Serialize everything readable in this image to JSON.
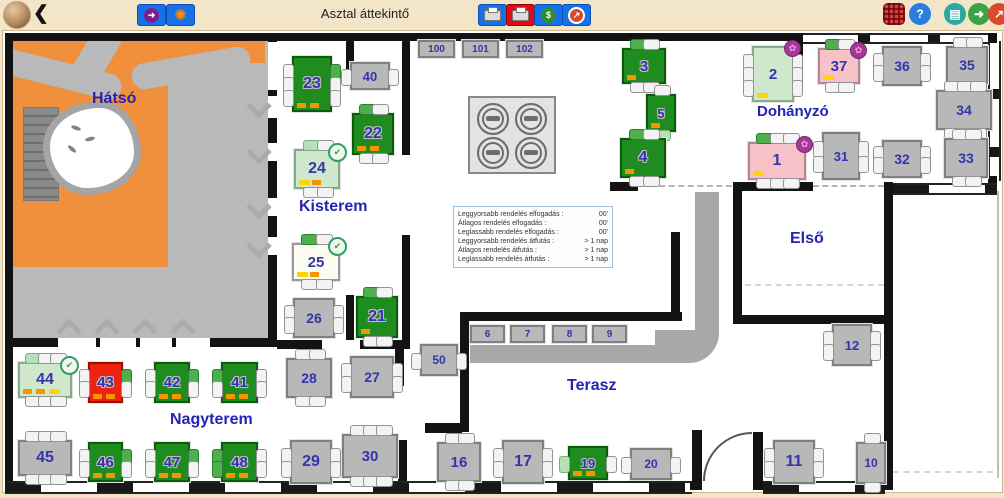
{
  "header": {
    "title": "Asztal áttekintő",
    "back_glyph": "❮",
    "help_glyph": "?"
  },
  "icons": {
    "check_glyph": "✔",
    "flower_glyph": "✿",
    "arrow_glyph": "➜",
    "burst_glyph": "✺",
    "dollar_glyph": "$",
    "trend_glyph": "↗",
    "device_glyph": "▤",
    "exit_glyph": "➜"
  },
  "colors": {
    "header_bg": "#f3e6c8",
    "accent_blue": "#1670e8",
    "accent_red": "#e30b13",
    "table_green": "#1e8c1e",
    "table_gray": "#b8b8b8",
    "table_pale": "#cfe8cb",
    "table_pink": "#f6c2c8",
    "table_red": "#ee2211",
    "mark_orange": "#f79400",
    "mark_yellow": "#ffd400",
    "number": "#3434ac"
  },
  "rooms": [
    {
      "id": "hatso",
      "label": "Hátsó"
    },
    {
      "id": "kisterem",
      "label": "Kisterem"
    },
    {
      "id": "dohanyzo",
      "label": "Dohányzó"
    },
    {
      "id": "elso",
      "label": "Első"
    },
    {
      "id": "terasz",
      "label": "Terasz"
    },
    {
      "id": "nagyterem",
      "label": "Nagyterem"
    }
  ],
  "stats_box": {
    "lines": [
      {
        "label": "Leggyorsabb rendelés elfogadás :",
        "value": "00'"
      },
      {
        "label": "Átlagos rendelés elfogadás :",
        "value": "00'"
      },
      {
        "label": "Leglassabb rendelés elfogadás :",
        "value": "00'"
      },
      {
        "label": "Leggyorsabb rendelés átfutás :",
        "value": "> 1 nap"
      },
      {
        "label": "Átlagos rendelés átfutás :",
        "value": "> 1 nap"
      },
      {
        "label": "Leglassabb rendelés átfutás :",
        "value": "> 1 nap"
      }
    ]
  },
  "tables": [
    {
      "label": "23",
      "x": 292,
      "y": 56,
      "w": 36,
      "h": 52,
      "color": "green",
      "fs": 16,
      "seats": {
        "l": [
          "w",
          "w",
          "w"
        ],
        "r": [
          "g",
          "w",
          "w"
        ]
      },
      "marks": [
        "orange",
        "orange"
      ]
    },
    {
      "label": "40",
      "x": 350,
      "y": 62,
      "w": 36,
      "h": 24,
      "color": "gray",
      "fs": 13,
      "seats": {
        "l": [
          "w"
        ],
        "r": [
          "w"
        ]
      }
    },
    {
      "label": "22",
      "x": 352,
      "y": 113,
      "w": 38,
      "h": 38,
      "color": "green",
      "fs": 16,
      "seats": {
        "t": [
          "g",
          "w"
        ],
        "b": [
          "w",
          "w"
        ]
      },
      "marks": [
        "orange",
        "orange"
      ]
    },
    {
      "label": "24",
      "x": 294,
      "y": 149,
      "w": 42,
      "h": 36,
      "color": "pale",
      "fs": 16,
      "badge": "check",
      "seats": {
        "t": [
          "p",
          "w"
        ],
        "b": [
          "w",
          "w"
        ]
      },
      "marks": [
        "yellow",
        "orange"
      ]
    },
    {
      "label": "25",
      "x": 292,
      "y": 243,
      "w": 44,
      "h": 34,
      "color": "white",
      "fs": 15,
      "badge": "check",
      "seats": {
        "t": [
          "g",
          "w"
        ],
        "b": [
          "w",
          "w"
        ]
      },
      "marks": [
        "yellow",
        "orange"
      ]
    },
    {
      "label": "26",
      "x": 293,
      "y": 298,
      "w": 38,
      "h": 36,
      "color": "gray",
      "fs": 14,
      "seats": {
        "l": [
          "w",
          "w"
        ],
        "r": [
          "w",
          "w"
        ]
      }
    },
    {
      "label": "21",
      "x": 356,
      "y": 296,
      "w": 38,
      "h": 38,
      "color": "green",
      "fs": 16,
      "seats": {
        "t": [
          "g",
          "w"
        ],
        "b": [
          "w",
          "w"
        ]
      },
      "marks": [
        "orange"
      ]
    },
    {
      "label": "100",
      "x": 418,
      "y": 40,
      "w": 33,
      "h": 14,
      "color": "gray",
      "fs": 10,
      "seats": {}
    },
    {
      "label": "101",
      "x": 462,
      "y": 40,
      "w": 33,
      "h": 14,
      "color": "gray",
      "fs": 10,
      "seats": {}
    },
    {
      "label": "102",
      "x": 506,
      "y": 40,
      "w": 33,
      "h": 14,
      "color": "gray",
      "fs": 10,
      "seats": {}
    },
    {
      "label": "3",
      "x": 622,
      "y": 48,
      "w": 40,
      "h": 32,
      "color": "green",
      "fs": 15,
      "seats": {
        "t": [
          "g",
          "w"
        ],
        "b": [
          "w",
          "w"
        ]
      },
      "marks": [
        "orange"
      ]
    },
    {
      "label": "5",
      "x": 646,
      "y": 94,
      "w": 26,
      "h": 34,
      "color": "green",
      "fs": 13,
      "seats": {
        "t": [
          "w"
        ],
        "b": [
          "p"
        ]
      },
      "marks": [
        "orange"
      ]
    },
    {
      "label": "4",
      "x": 620,
      "y": 138,
      "w": 42,
      "h": 36,
      "color": "green",
      "fs": 16,
      "seats": {
        "t": [
          "g",
          "w"
        ],
        "b": [
          "w",
          "w"
        ]
      },
      "marks": [
        "orange"
      ]
    },
    {
      "label": "2",
      "x": 752,
      "y": 46,
      "w": 38,
      "h": 52,
      "color": "pale",
      "fs": 15,
      "badge": "flower",
      "seats": {
        "l": [
          "w",
          "w",
          "w"
        ],
        "r": [
          "w",
          "w",
          "w"
        ]
      },
      "marks": [
        "yellow"
      ]
    },
    {
      "label": "37",
      "x": 818,
      "y": 48,
      "w": 38,
      "h": 32,
      "color": "pink",
      "fs": 15,
      "badge": "flower",
      "seats": {
        "t": [
          "g",
          "w"
        ],
        "b": [
          "w",
          "w"
        ]
      },
      "marks": [
        "yellow"
      ]
    },
    {
      "label": "36",
      "x": 882,
      "y": 46,
      "w": 36,
      "h": 36,
      "color": "gray",
      "fs": 14,
      "seats": {
        "l": [
          "w",
          "w"
        ],
        "r": [
          "w",
          "w"
        ]
      }
    },
    {
      "label": "35",
      "x": 946,
      "y": 46,
      "w": 38,
      "h": 34,
      "color": "gray",
      "fs": 14,
      "seats": {
        "t": [
          "w",
          "w"
        ],
        "b": [
          "w",
          "w"
        ]
      }
    },
    {
      "label": "34",
      "x": 936,
      "y": 90,
      "w": 52,
      "h": 36,
      "color": "gray",
      "fs": 14,
      "seats": {
        "t": [
          "w",
          "w",
          "w"
        ],
        "b": [
          "w",
          "w",
          "w"
        ]
      }
    },
    {
      "label": "1",
      "x": 748,
      "y": 142,
      "w": 54,
      "h": 34,
      "color": "pink",
      "fs": 16,
      "badge": "flower",
      "seats": {
        "t": [
          "g",
          "w",
          "w"
        ],
        "b": [
          "w",
          "w",
          "w"
        ]
      },
      "marks": [
        "yellow"
      ]
    },
    {
      "label": "31",
      "x": 822,
      "y": 132,
      "w": 34,
      "h": 44,
      "color": "gray",
      "fs": 13,
      "seats": {
        "l": [
          "w",
          "w"
        ],
        "r": [
          "w",
          "w"
        ]
      }
    },
    {
      "label": "32",
      "x": 882,
      "y": 140,
      "w": 36,
      "h": 34,
      "color": "gray",
      "fs": 14,
      "seats": {
        "l": [
          "w",
          "w"
        ],
        "r": [
          "w",
          "w"
        ]
      }
    },
    {
      "label": "33",
      "x": 944,
      "y": 138,
      "w": 40,
      "h": 36,
      "color": "gray",
      "fs": 14,
      "seats": {
        "t": [
          "w",
          "w"
        ],
        "b": [
          "w",
          "w"
        ]
      }
    },
    {
      "label": "12",
      "x": 832,
      "y": 324,
      "w": 36,
      "h": 38,
      "color": "gray",
      "fs": 13,
      "seats": {
        "l": [
          "w",
          "w"
        ],
        "r": [
          "w",
          "w"
        ]
      }
    },
    {
      "label": "6",
      "x": 470,
      "y": 325,
      "w": 31,
      "h": 14,
      "color": "gray",
      "fs": 10,
      "seats": {}
    },
    {
      "label": "7",
      "x": 510,
      "y": 325,
      "w": 31,
      "h": 14,
      "color": "gray",
      "fs": 10,
      "seats": {}
    },
    {
      "label": "8",
      "x": 552,
      "y": 325,
      "w": 31,
      "h": 14,
      "color": "gray",
      "fs": 10,
      "seats": {}
    },
    {
      "label": "9",
      "x": 592,
      "y": 325,
      "w": 31,
      "h": 14,
      "color": "gray",
      "fs": 10,
      "seats": {}
    },
    {
      "label": "50",
      "x": 420,
      "y": 344,
      "w": 34,
      "h": 28,
      "color": "gray",
      "fs": 12,
      "seats": {
        "l": [
          "w"
        ],
        "r": [
          "w"
        ]
      }
    },
    {
      "label": "44",
      "x": 18,
      "y": 362,
      "w": 50,
      "h": 32,
      "color": "pale",
      "fs": 16,
      "badge": "check",
      "seats": {
        "t": [
          "p",
          "w",
          "w"
        ],
        "b": [
          "w",
          "w",
          "w"
        ]
      },
      "marks": [
        "orange",
        "orange",
        "yellow"
      ]
    },
    {
      "label": "43",
      "x": 88,
      "y": 362,
      "w": 31,
      "h": 37,
      "color": "red",
      "fs": 15,
      "seats": {
        "l": [
          "w",
          "w"
        ],
        "r": [
          "g",
          "w"
        ]
      },
      "marks": [
        "orange",
        "orange"
      ]
    },
    {
      "label": "42",
      "x": 154,
      "y": 362,
      "w": 32,
      "h": 37,
      "color": "green",
      "fs": 15,
      "seats": {
        "l": [
          "w",
          "w"
        ],
        "r": [
          "g",
          "w"
        ]
      },
      "marks": [
        "orange",
        "orange"
      ]
    },
    {
      "label": "41",
      "x": 221,
      "y": 362,
      "w": 33,
      "h": 37,
      "color": "green",
      "fs": 15,
      "seats": {
        "l": [
          "g",
          "w"
        ],
        "r": [
          "w",
          "w"
        ]
      },
      "marks": [
        "orange",
        "orange"
      ]
    },
    {
      "label": "45",
      "x": 18,
      "y": 440,
      "w": 50,
      "h": 32,
      "color": "gray",
      "fs": 16,
      "seats": {
        "t": [
          "w",
          "w",
          "w"
        ],
        "b": [
          "w",
          "w",
          "w"
        ]
      }
    },
    {
      "label": "46",
      "x": 88,
      "y": 442,
      "w": 31,
      "h": 36,
      "color": "green",
      "fs": 15,
      "seats": {
        "l": [
          "w",
          "w"
        ],
        "r": [
          "g",
          "w"
        ]
      },
      "marks": [
        "orange",
        "orange"
      ]
    },
    {
      "label": "47",
      "x": 154,
      "y": 442,
      "w": 32,
      "h": 36,
      "color": "green",
      "fs": 15,
      "seats": {
        "l": [
          "w",
          "w"
        ],
        "r": [
          "g",
          "w"
        ]
      },
      "marks": [
        "orange",
        "orange"
      ]
    },
    {
      "label": "48",
      "x": 221,
      "y": 442,
      "w": 33,
      "h": 36,
      "color": "green",
      "fs": 15,
      "seats": {
        "l": [
          "g",
          "g"
        ],
        "r": [
          "w",
          "w"
        ]
      },
      "marks": [
        "orange",
        "orange"
      ]
    },
    {
      "label": "28",
      "x": 286,
      "y": 358,
      "w": 42,
      "h": 36,
      "color": "gray",
      "fs": 14,
      "seats": {
        "t": [
          "w",
          "w"
        ],
        "b": [
          "w",
          "w"
        ]
      }
    },
    {
      "label": "27",
      "x": 350,
      "y": 356,
      "w": 40,
      "h": 38,
      "color": "gray",
      "fs": 14,
      "seats": {
        "l": [
          "w",
          "w"
        ],
        "r": [
          "w",
          "w"
        ]
      }
    },
    {
      "label": "29",
      "x": 290,
      "y": 440,
      "w": 38,
      "h": 40,
      "color": "gray",
      "fs": 16,
      "seats": {
        "l": [
          "w",
          "w"
        ],
        "r": [
          "w",
          "w"
        ]
      }
    },
    {
      "label": "30",
      "x": 342,
      "y": 434,
      "w": 52,
      "h": 40,
      "color": "gray",
      "fs": 15,
      "seats": {
        "t": [
          "w",
          "w",
          "w"
        ],
        "b": [
          "w",
          "w",
          "w"
        ]
      }
    },
    {
      "label": "16",
      "x": 437,
      "y": 442,
      "w": 40,
      "h": 36,
      "color": "gray",
      "fs": 15,
      "seats": {
        "t": [
          "w",
          "w"
        ],
        "b": [
          "w",
          "w"
        ]
      }
    },
    {
      "label": "17",
      "x": 502,
      "y": 440,
      "w": 38,
      "h": 40,
      "color": "gray",
      "fs": 16,
      "seats": {
        "l": [
          "w",
          "w"
        ],
        "r": [
          "w",
          "w"
        ]
      }
    },
    {
      "label": "19",
      "x": 568,
      "y": 446,
      "w": 36,
      "h": 30,
      "color": "green",
      "fs": 13,
      "seats": {
        "l": [
          "p"
        ],
        "r": [
          "w"
        ]
      },
      "marks": [
        "orange",
        "orange"
      ]
    },
    {
      "label": "20",
      "x": 630,
      "y": 448,
      "w": 38,
      "h": 28,
      "color": "gray",
      "fs": 12,
      "seats": {
        "l": [
          "w"
        ],
        "r": [
          "w"
        ]
      }
    },
    {
      "label": "11",
      "x": 773,
      "y": 440,
      "w": 38,
      "h": 40,
      "color": "gray",
      "fs": 16,
      "seats": {
        "l": [
          "w",
          "w"
        ],
        "r": [
          "w",
          "w"
        ]
      }
    },
    {
      "label": "10",
      "x": 856,
      "y": 442,
      "w": 26,
      "h": 38,
      "color": "gray",
      "fs": 12,
      "seats": {
        "t": [
          "w"
        ],
        "b": [
          "w"
        ]
      }
    }
  ]
}
